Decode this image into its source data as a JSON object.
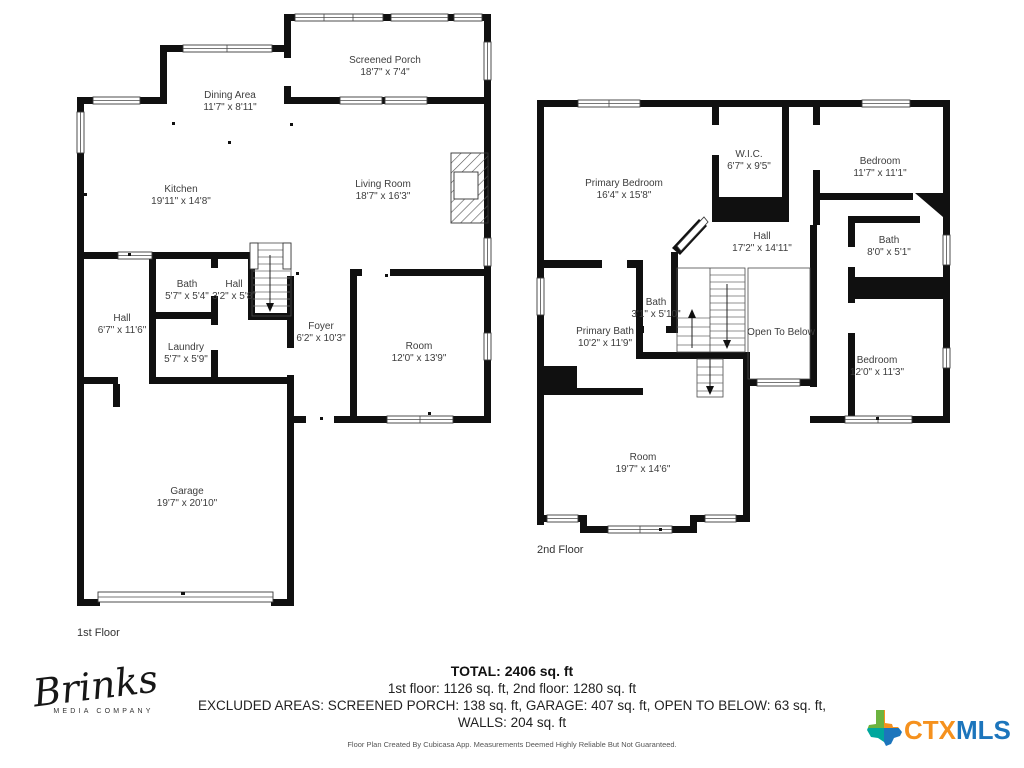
{
  "floor1": {
    "label": "1st Floor",
    "rooms": {
      "porch": {
        "name": "Screened Porch",
        "dims": "18'7\" x 7'4\""
      },
      "dining": {
        "name": "Dining Area",
        "dims": "11'7\" x 8'11\""
      },
      "kitchen": {
        "name": "Kitchen",
        "dims": "19'11\" x 14'8\""
      },
      "living": {
        "name": "Living Room",
        "dims": "18'7\" x 16'3\""
      },
      "bath": {
        "name": "Bath",
        "dims": "5'7\" x 5'4\""
      },
      "hallsmall": {
        "name": "Hall",
        "dims": "3'2\" x 5'8\""
      },
      "hall": {
        "name": "Hall",
        "dims": "6'7\" x 11'6\""
      },
      "laundry": {
        "name": "Laundry",
        "dims": "5'7\" x 5'9\""
      },
      "foyer": {
        "name": "Foyer",
        "dims": "6'2\" x 10'3\""
      },
      "room": {
        "name": "Room",
        "dims": "12'0\" x 13'9\""
      },
      "garage": {
        "name": "Garage",
        "dims": "19'7\" x 20'10\""
      }
    }
  },
  "floor2": {
    "label": "2nd Floor",
    "rooms": {
      "primary_bedroom": {
        "name": "Primary Bedroom",
        "dims": "16'4\" x 15'8\""
      },
      "wic": {
        "name": "W.I.C.",
        "dims": "6'7\" x 9'5\""
      },
      "bedroom_top": {
        "name": "Bedroom",
        "dims": "11'7\" x 11'1\""
      },
      "hall": {
        "name": "Hall",
        "dims": "17'2\" x 14'11\""
      },
      "bath": {
        "name": "Bath",
        "dims": "8'0\" x 5'1\""
      },
      "primary_bath": {
        "name": "Primary Bath",
        "dims": "10'2\" x 11'9\""
      },
      "bath_small": {
        "name": "Bath",
        "dims": "3'1\" x 5'10\""
      },
      "open_below": {
        "name": "Open To Below"
      },
      "bedroom_bottom": {
        "name": "Bedroom",
        "dims": "12'0\" x 11'3\""
      },
      "room": {
        "name": "Room",
        "dims": "19'7\" x 14'6\""
      }
    }
  },
  "summary": {
    "total": "TOTAL: 2406 sq. ft",
    "floors": "1st floor: 1126 sq. ft, 2nd floor: 1280 sq. ft",
    "excluded": "EXCLUDED AREAS: SCREENED PORCH: 138 sq. ft, GARAGE: 407 sq. ft, OPEN TO BELOW: 63 sq. ft,",
    "walls": "WALLS: 204 sq. ft",
    "disclaimer": "Floor Plan Created By Cubicasa App. Measurements Deemed Highly Reliable But Not Guaranteed."
  },
  "branding": {
    "brinks_name": "Brinks",
    "brinks_subtitle": "MEDIA COMPANY",
    "ctx": "CTX",
    "mls": "MLS",
    "colors": {
      "ctx_orange": "#F5911E",
      "mls_blue": "#1C75BC",
      "texas_green": "#6CB33F",
      "texas_teal": "#00A79D"
    }
  }
}
